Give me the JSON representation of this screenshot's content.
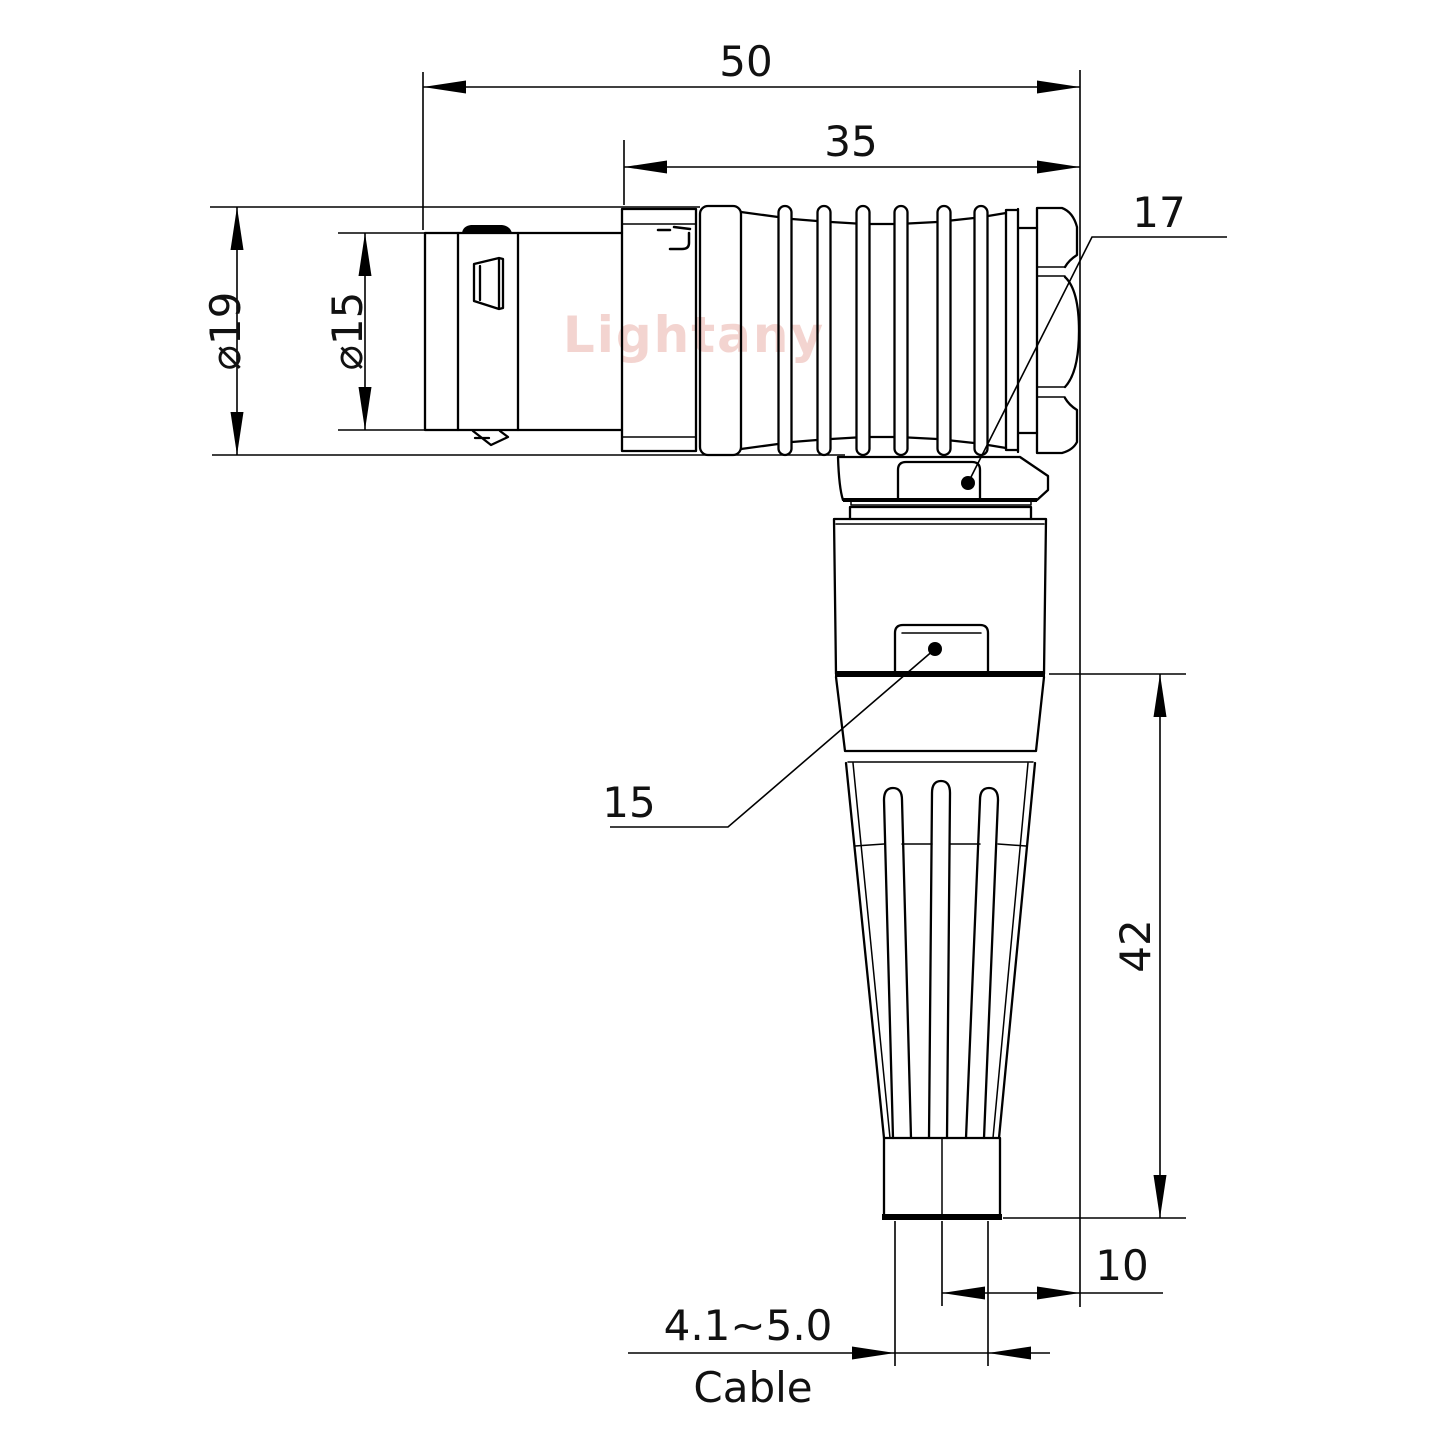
{
  "drawing": {
    "watermark": {
      "text": "Lightany",
      "color": "#f0c6c1"
    },
    "dimensions": {
      "overall_length": "50",
      "rear_section_length": "35",
      "outer_diameter": "⌀19",
      "front_diameter": "⌀15",
      "hex_reference": "17",
      "boss_reference": "15",
      "leg_length": "42",
      "axis_offset": "10",
      "cable_diameter_range": "4.1~5.0",
      "cable_label": "Cable"
    },
    "style": {
      "line_color": "#000000",
      "background": "#ffffff"
    }
  }
}
